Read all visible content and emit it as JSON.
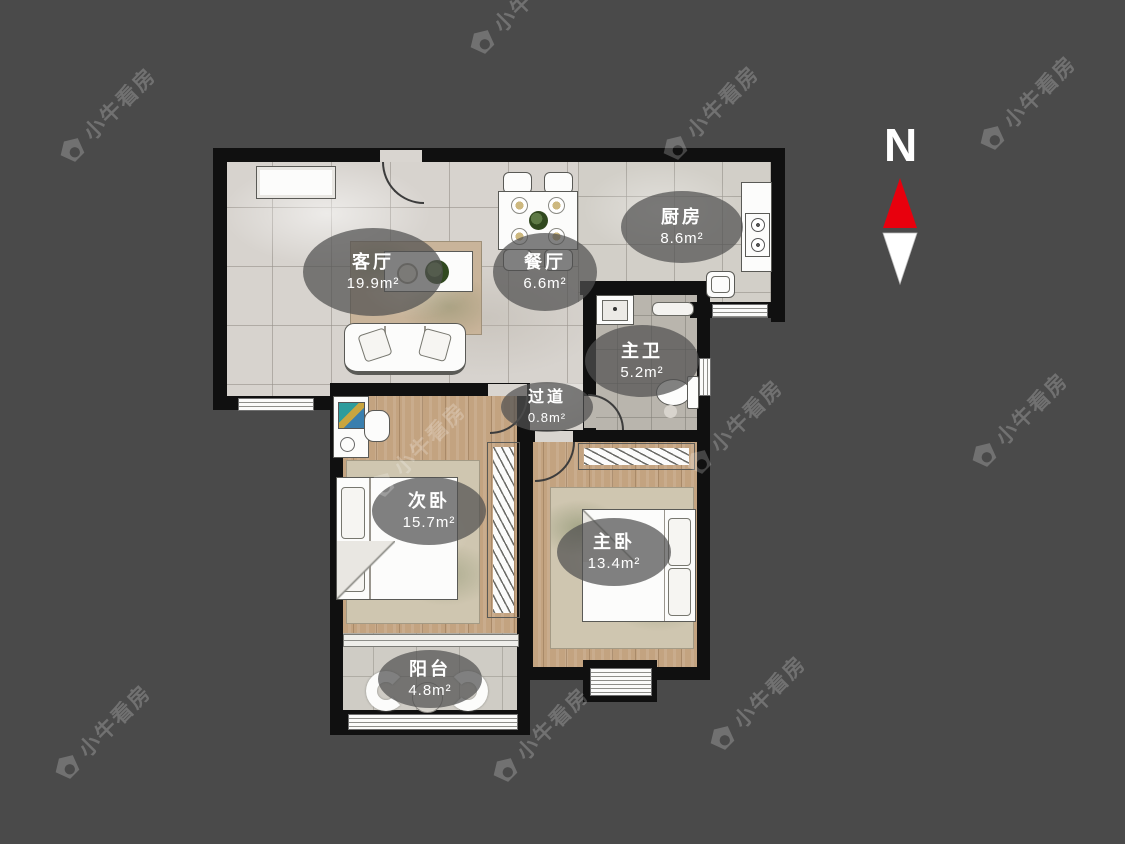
{
  "page": {
    "background_color": "#4a4a4a"
  },
  "watermark": {
    "text": "小牛看房",
    "icon": "bull-logo-icon"
  },
  "compass": {
    "label": "N",
    "north_color": "#e8000d",
    "south_color": "#ffffff"
  },
  "rooms": [
    {
      "id": "living",
      "name": "客厅",
      "area": "19.9m²"
    },
    {
      "id": "dining",
      "name": "餐厅",
      "area": "6.6m²"
    },
    {
      "id": "kitchen",
      "name": "厨房",
      "area": "8.6m²"
    },
    {
      "id": "bathroom",
      "name": "主卫",
      "area": "5.2m²"
    },
    {
      "id": "hallway",
      "name": "过道",
      "area": "0.8m²"
    },
    {
      "id": "bedroom2",
      "name": "次卧",
      "area": "15.7m²"
    },
    {
      "id": "bedroom1",
      "name": "主卧",
      "area": "13.4m²"
    },
    {
      "id": "balcony",
      "name": "阳台",
      "area": "4.8m²"
    }
  ],
  "colors": {
    "wall": "#101010",
    "marble_floor": "#d7d3ce",
    "wood_floor": "#c3a380",
    "bath_floor": "#b9b5ad",
    "balcony_floor": "#cfccc5",
    "label_bubble": "rgba(80,80,80,0.72)"
  }
}
